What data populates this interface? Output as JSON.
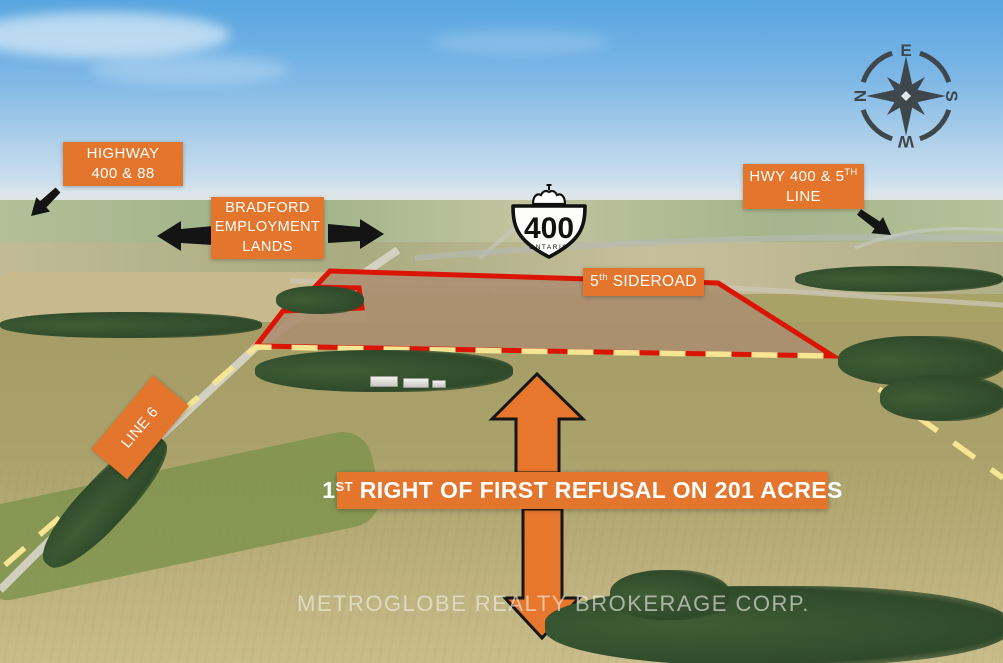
{
  "meta": {
    "description": "Aerial real-estate photo with property boundary and road callouts"
  },
  "colors": {
    "label_orange": "#e4752c",
    "boundary_red": "#da1505",
    "boundary_dash_yellow": "#f6e593",
    "arrow_orange": "#e8772e",
    "arrow_black": "#141414",
    "compass_gray": "#3d474c",
    "label_text": "#ffffff"
  },
  "callouts": {
    "highway_400_88": {
      "lines": [
        "HIGHWAY",
        "400 & 88"
      ]
    },
    "bradford": {
      "lines": [
        "BRADFORD",
        "EMPLOYMENT",
        "LANDS"
      ]
    },
    "hwy400_5th_line": {
      "line1_main": "HWY 400 & 5",
      "line1_sup": "TH",
      "line2": "LINE"
    },
    "fifth_sideroad": {
      "num": "5",
      "sup": "th",
      "rest": " SIDEROAD"
    },
    "line6": {
      "text": "LINE 6"
    }
  },
  "banner": {
    "num": "1",
    "sup": "ST",
    "rest": " RIGHT OF FIRST REFUSAL ON 201 ACRES"
  },
  "highway_shield": {
    "route": "400",
    "region": "ONTARIO"
  },
  "compass": {
    "top": "E",
    "right": "S",
    "bottom": "W",
    "left": "N"
  },
  "watermark": {
    "text": "METROGLOBE REALTY BROKERAGE CORP."
  }
}
